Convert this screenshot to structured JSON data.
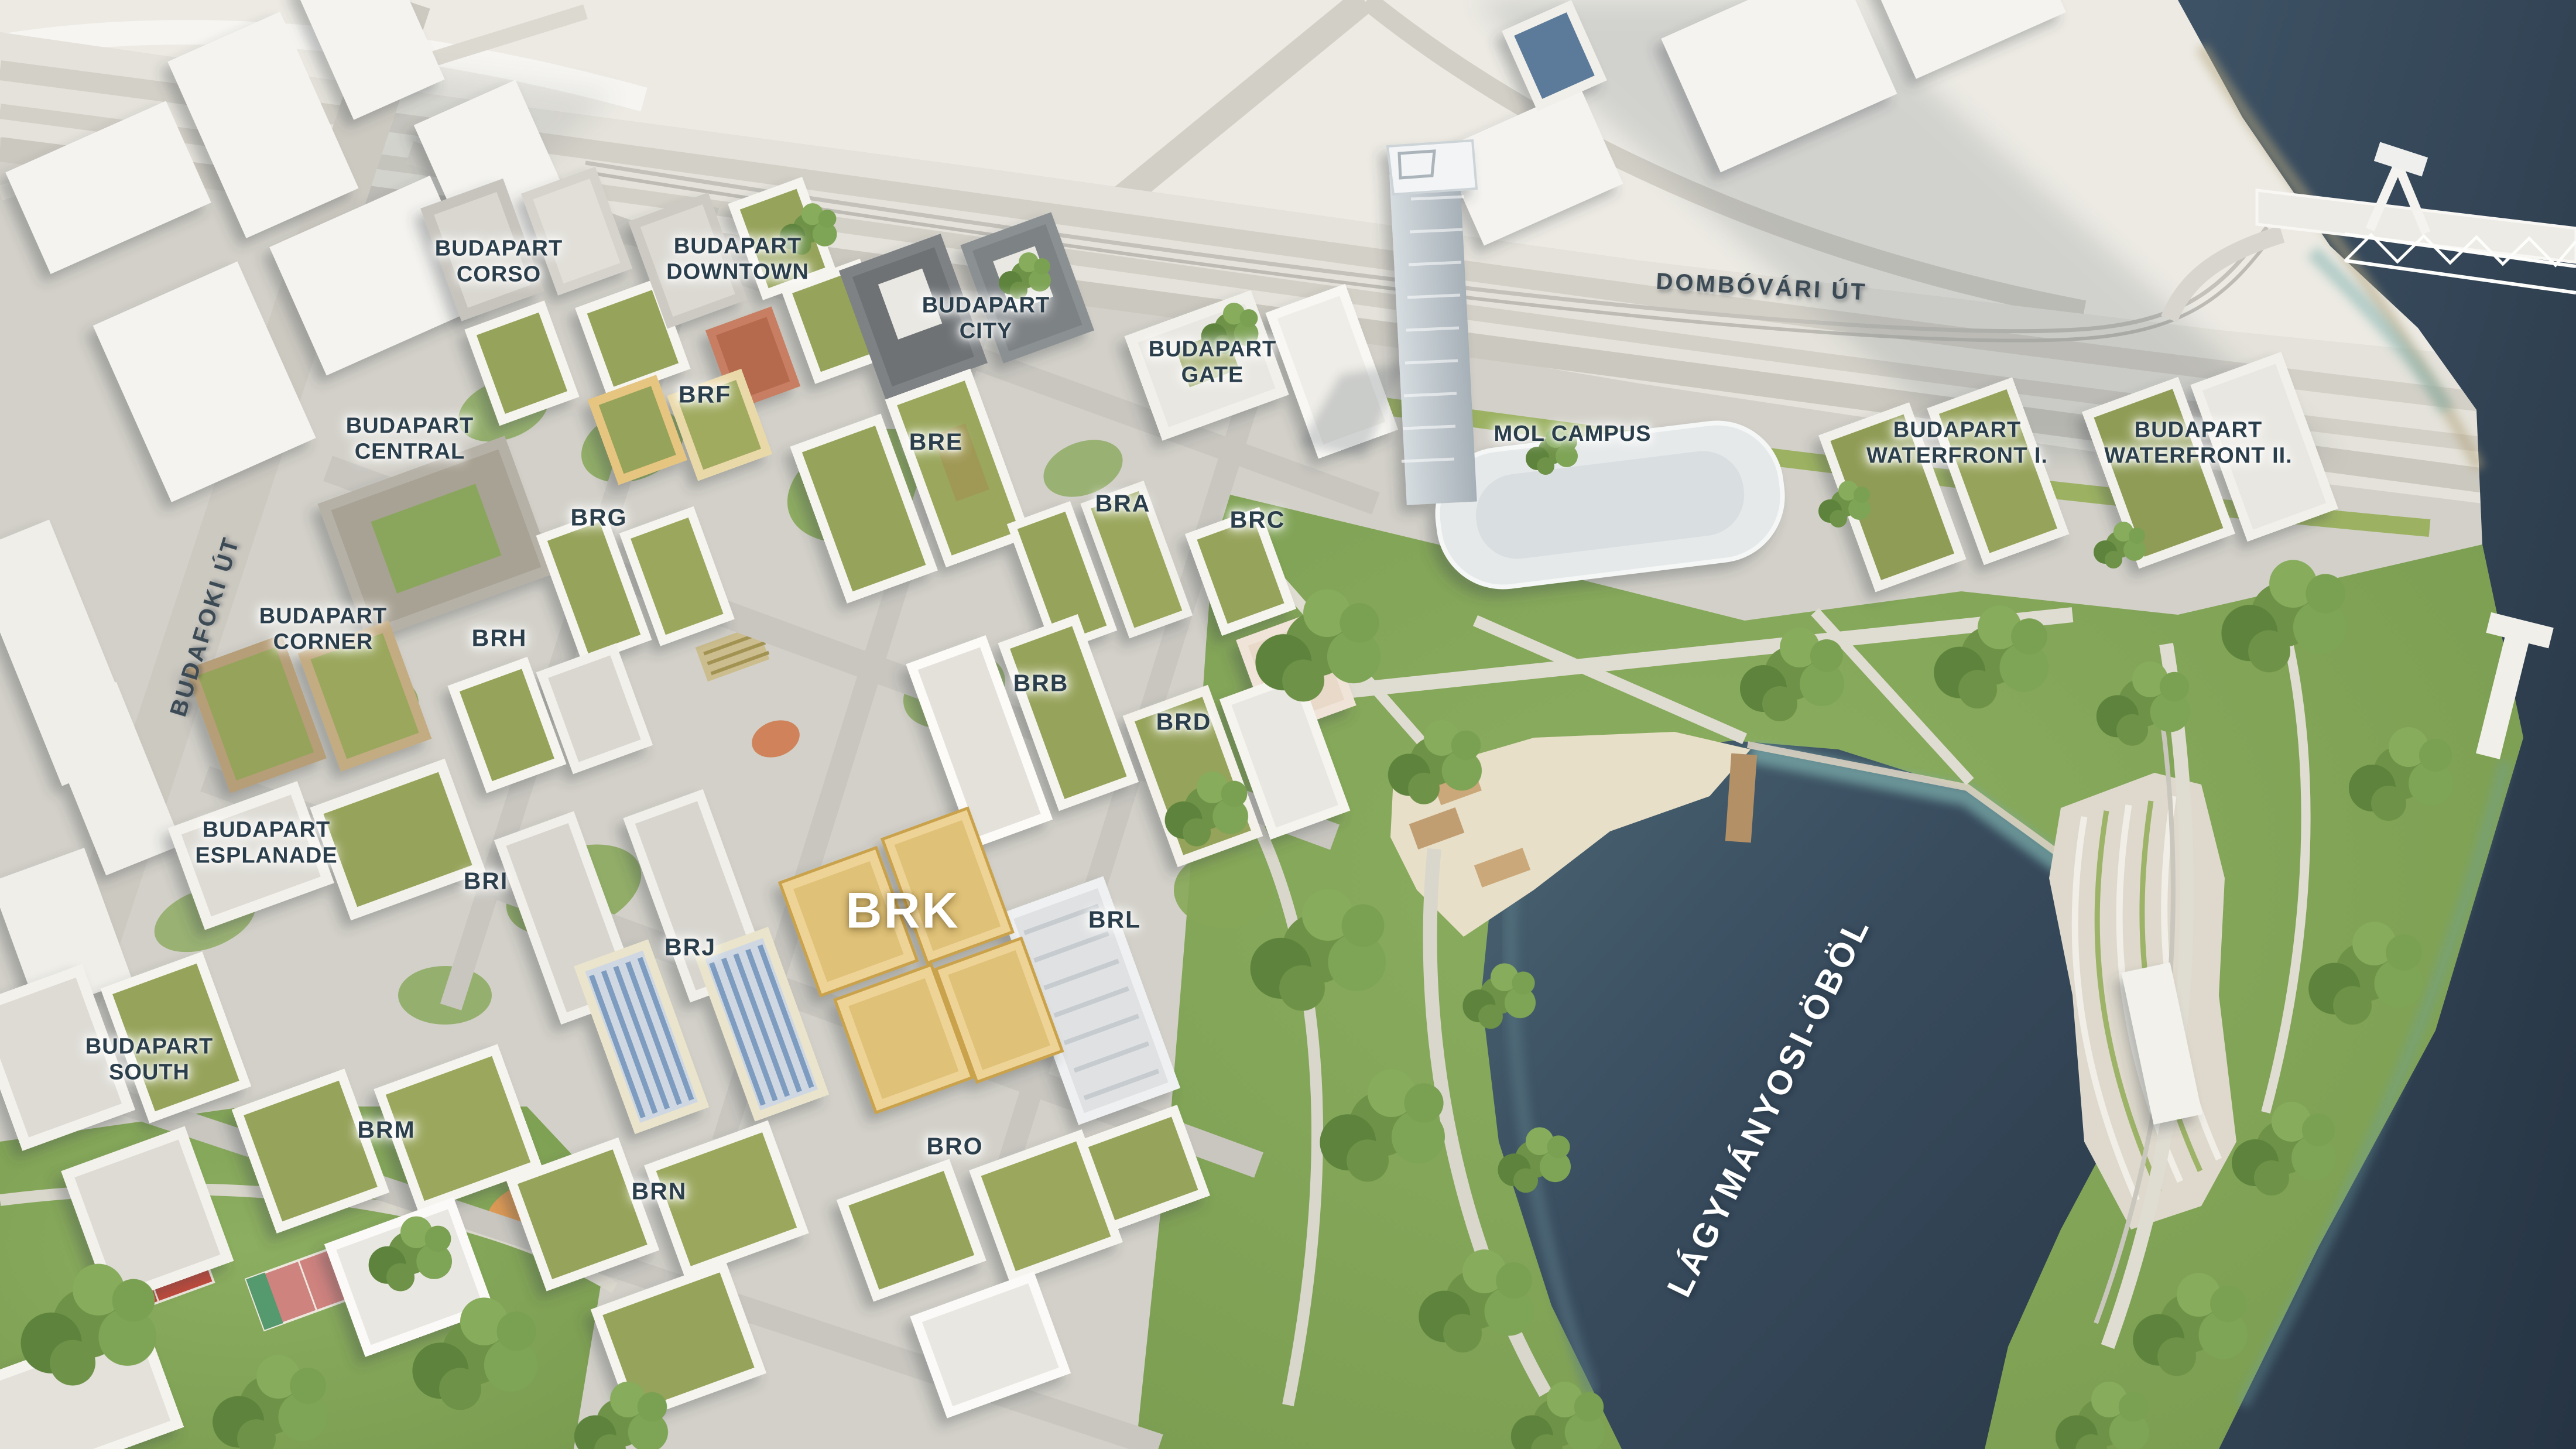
{
  "labels": {
    "developments": [
      {
        "id": "corso",
        "line1": "BUDAPART",
        "line2": "CORSO"
      },
      {
        "id": "downtown",
        "line1": "BUDAPART",
        "line2": "DOWNTOWN"
      },
      {
        "id": "city",
        "line1": "BUDAPART",
        "line2": "CITY"
      },
      {
        "id": "gate",
        "line1": "BUDAPART",
        "line2": "GATE"
      },
      {
        "id": "central",
        "line1": "BUDAPART",
        "line2": "CENTRAL"
      },
      {
        "id": "corner",
        "line1": "BUDAPART",
        "line2": "CORNER"
      },
      {
        "id": "esplanade",
        "line1": "BUDAPART",
        "line2": "ESPLANADE"
      },
      {
        "id": "south",
        "line1": "BUDAPART",
        "line2": "SOUTH"
      },
      {
        "id": "waterfront-1",
        "line1": "BUDAPART",
        "line2": "WATERFRONT I."
      },
      {
        "id": "waterfront-2",
        "line1": "BUDAPART",
        "line2": "WATERFRONT II."
      }
    ],
    "buildings": [
      "BRA",
      "BRB",
      "BRC",
      "BRD",
      "BRE",
      "BRF",
      "BRG",
      "BRH",
      "BRI",
      "BRJ",
      "BRK",
      "BRL",
      "BRM",
      "BRN",
      "BRO"
    ],
    "landmark": {
      "mol_campus": "MOL CAMPUS"
    },
    "roads": {
      "dombovari": "DOMBÓVÁRI ÚT",
      "budafoki": "BUDAFOKI ÚT"
    },
    "water": {
      "bay": "LÁGYMÁNYOSI-ÖBÖL"
    },
    "highlighted_building": "BRK"
  },
  "colors": {
    "label_dark": "#2b3e4c",
    "label_white": "#ffffff",
    "bay_water": "#35485a",
    "danube_water": "#2e3f50",
    "park_green": "#83a558",
    "highlight_yellow": "#eed396",
    "ground": "#d5d3cb"
  }
}
